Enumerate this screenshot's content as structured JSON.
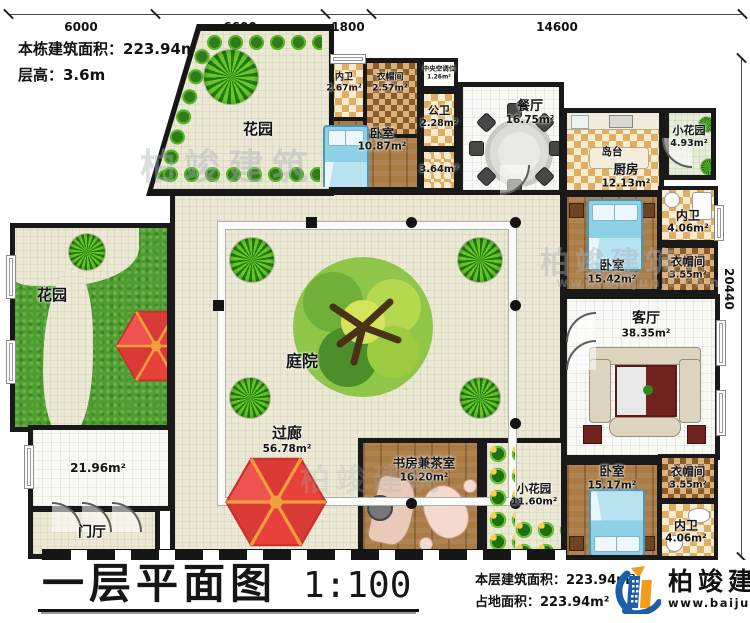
{
  "header": {
    "building_area": "本栋建筑面积：223.94m²",
    "floor_height": "层高：3.6m"
  },
  "dimensions": {
    "top": [
      "6000",
      "6600",
      "1800",
      "14600"
    ],
    "right": "20440"
  },
  "rooms": {
    "garden_top": {
      "name": "花园"
    },
    "garden_left": {
      "name": "花园"
    },
    "bath_top": {
      "name": "内卫",
      "area": "2.67m²"
    },
    "cloak_top": {
      "name": "衣帽间",
      "area": "2.57m²"
    },
    "ac_unit": {
      "name": "中央空调位",
      "area": "1.26m²"
    },
    "bedroom_top": {
      "name": "卧室",
      "area": "10.87m²"
    },
    "public_bath": {
      "name": "公卫",
      "area": "2.28m²"
    },
    "hallway": {
      "area": "3.64m²"
    },
    "dining": {
      "name": "餐厅",
      "area": "16.75m²"
    },
    "island": {
      "name": "岛台"
    },
    "kitchen": {
      "name": "厨房",
      "area": "12.13m²"
    },
    "garden_small_top": {
      "name": "小花园",
      "area": "4.93m²"
    },
    "bath_mid": {
      "name": "内卫",
      "area": "4.06m²"
    },
    "bedroom_mid": {
      "name": "卧室",
      "area": "15.42m²"
    },
    "cloak_mid": {
      "name": "衣帽间",
      "area": "3.55m²"
    },
    "living": {
      "name": "客厅",
      "area": "38.35m²"
    },
    "courtyard": {
      "name": "庭院"
    },
    "corridor": {
      "name": "过廊",
      "area": "56.78m²"
    },
    "storage": {
      "area": "21.96m²"
    },
    "foyer": {
      "name": "门厅"
    },
    "study": {
      "name": "书房兼茶室",
      "area": "16.20m²"
    },
    "garden_small_bottom": {
      "name": "小花园",
      "area": "11.60m²"
    },
    "bedroom_bottom": {
      "name": "卧室",
      "area": "15.17m²"
    },
    "cloak_bottom": {
      "name": "衣帽间",
      "area": "3.55m²"
    },
    "bath_bottom": {
      "name": "内卫",
      "area": "4.06m²"
    }
  },
  "footer": {
    "title": "一层平面图",
    "scale": "1:100",
    "floor_area": "本层建筑面积：223.94m²",
    "land_area": "占地面积：223.94m²"
  },
  "brand": {
    "name": "柏竣建筑",
    "site": "www.baijunjz.com"
  },
  "watermark": {
    "text": "柏竣建筑",
    "site": "www.baijunjz.com"
  },
  "colors": {
    "wall": "#191919",
    "umbrella_red": "#e8413c",
    "umbrella_rib": "#f0a03a",
    "grass": "#4f9e2d",
    "wood": "#a97b45",
    "bed_blue": "#8ed0e6",
    "logo_blue": "#1b5fa8",
    "logo_orange": "#f29b1d"
  }
}
